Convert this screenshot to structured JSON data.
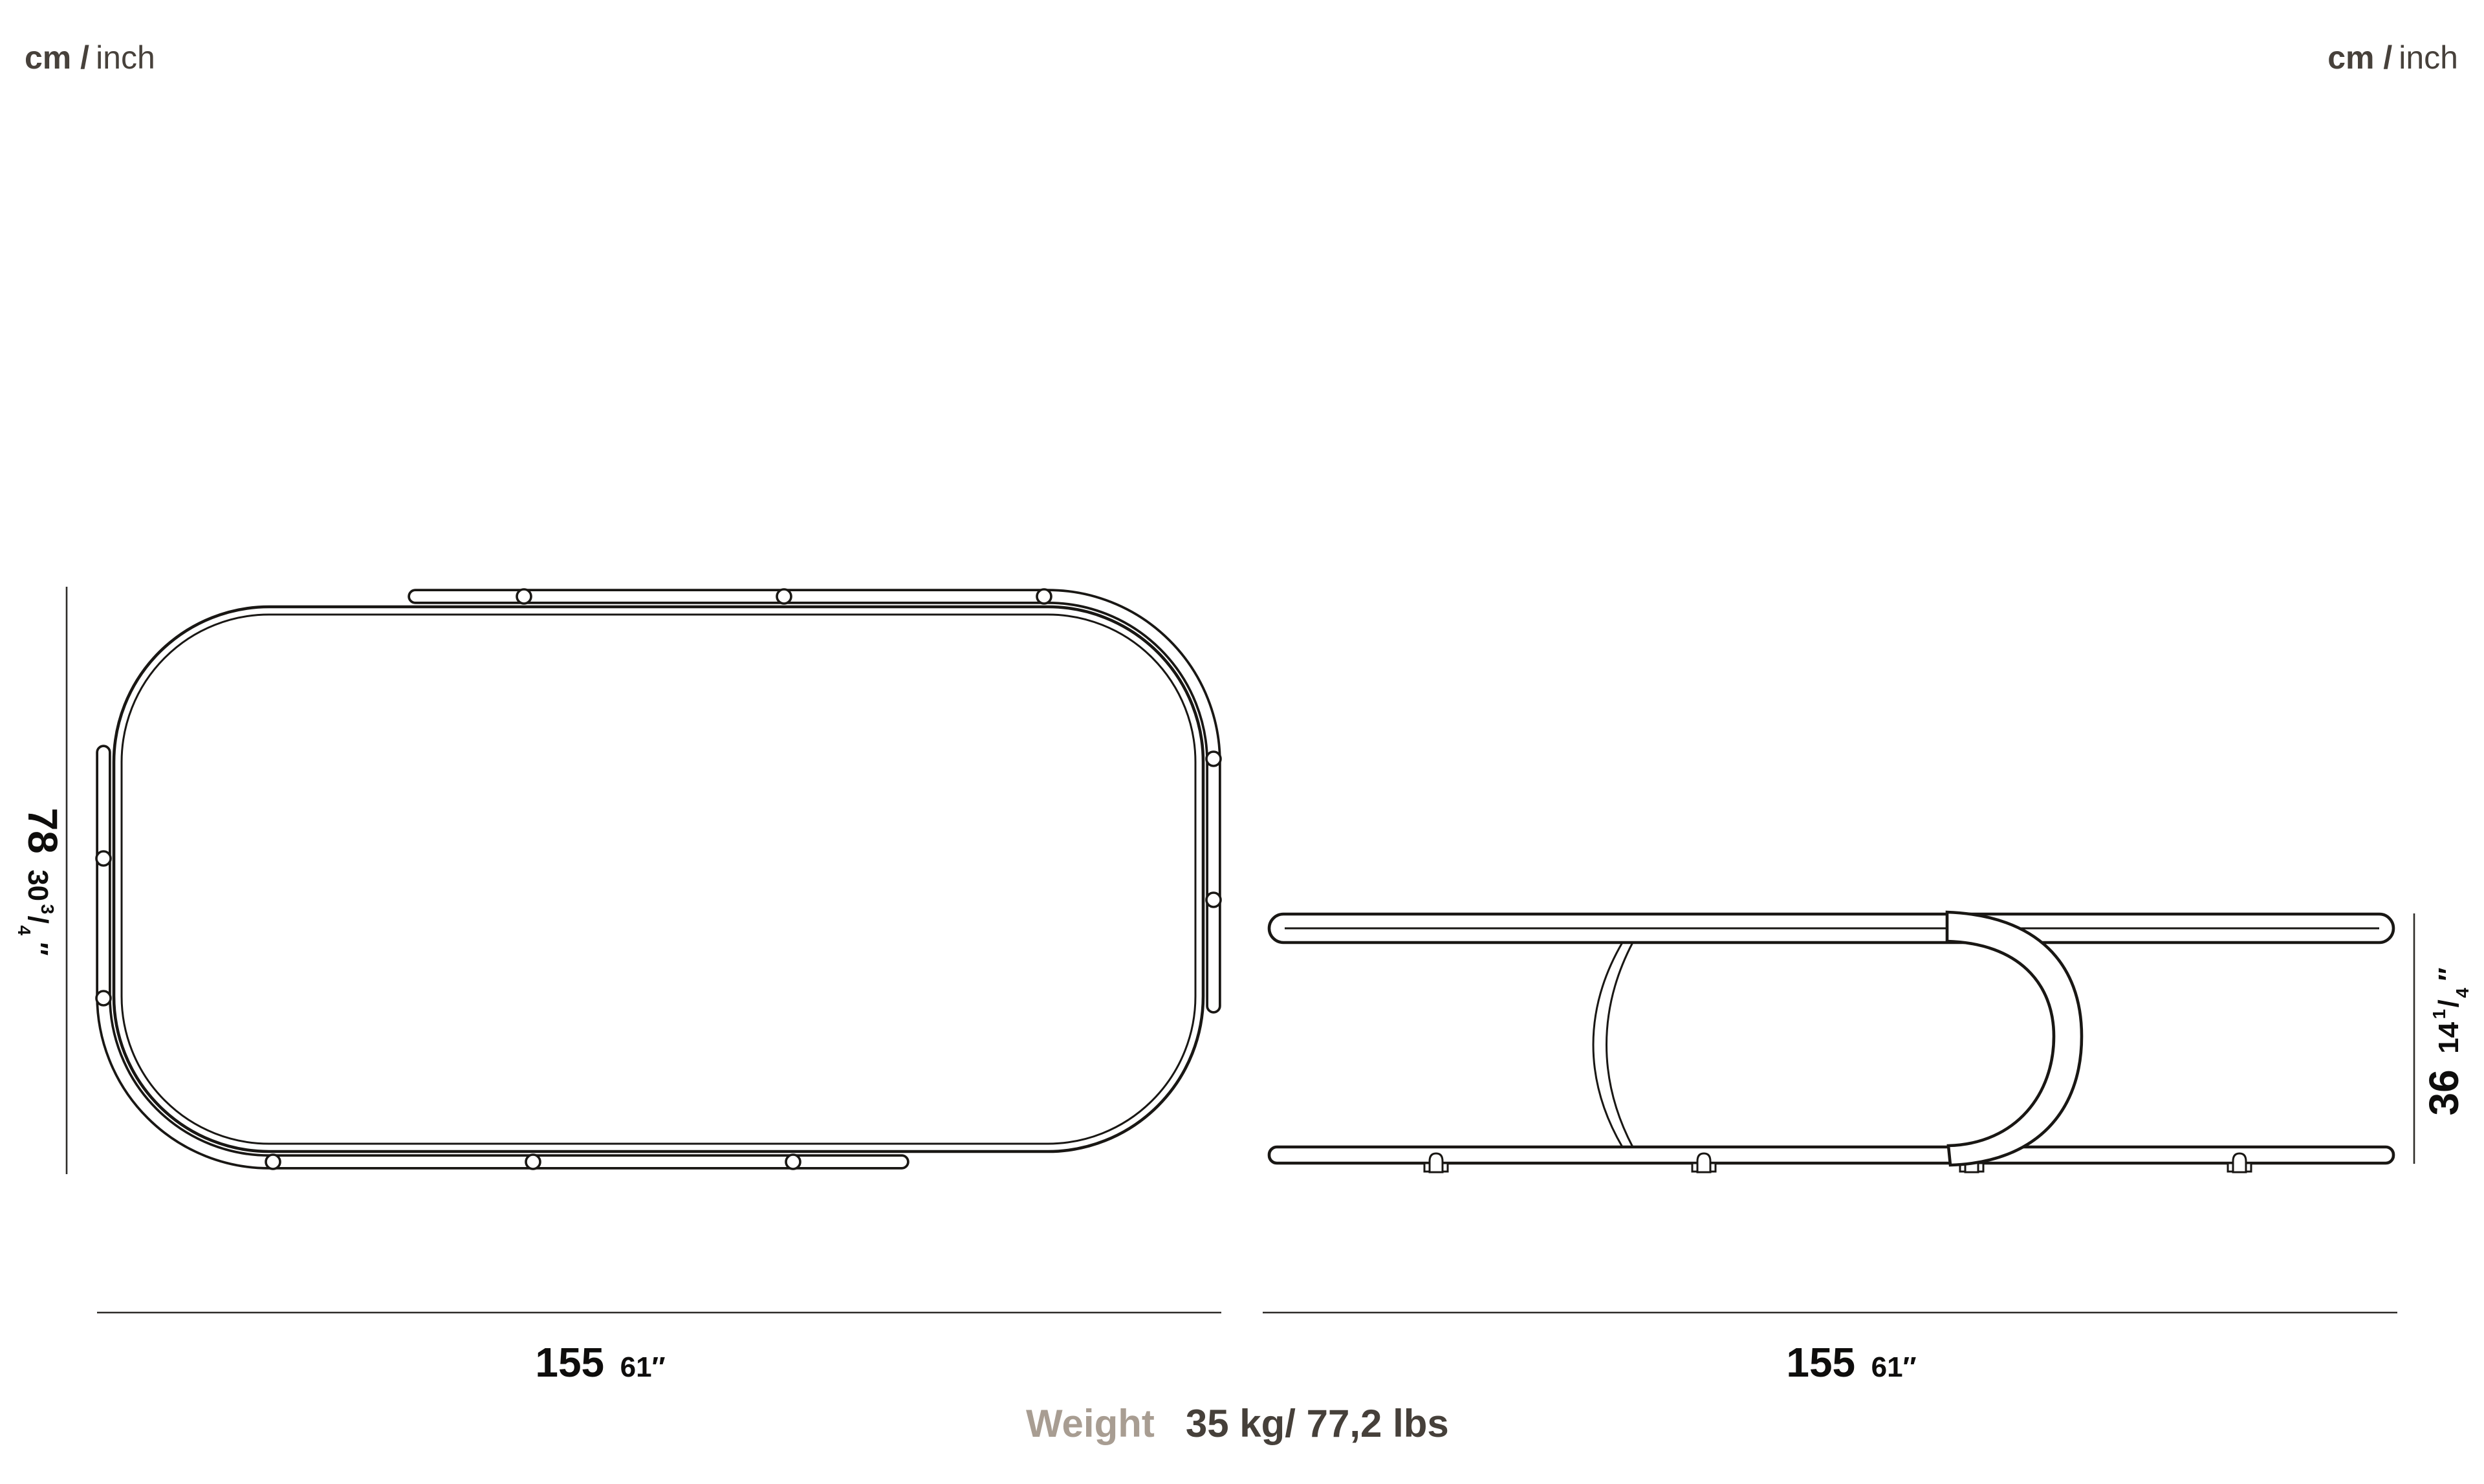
{
  "units_top_left": {
    "bold": "cm /",
    "regular": "inch"
  },
  "units_top_right": {
    "bold": "cm /",
    "regular": "inch"
  },
  "frac_slash": "/",
  "left_view": {
    "height_cm": "78",
    "height_in_whole": "30",
    "height_frac_num": "3",
    "height_frac_den": "4",
    "height_in_mark": "″",
    "width_cm": "155",
    "width_in": "61″"
  },
  "right_view": {
    "height_cm": "36",
    "height_in_whole": "14",
    "height_frac_num": "1",
    "height_frac_den": "4",
    "height_in_mark": "″",
    "width_cm": "155",
    "width_in": "61″"
  },
  "weight_label": "Weight",
  "weight_value": "35 kg/ 77,2 lbs",
  "colors": {
    "ink": "#191714",
    "dim_text": "#0e0d0c",
    "units_text": "#47413b",
    "weight_label": "#a89d92",
    "weight_value": "#46403a",
    "background": "#ffffff"
  }
}
